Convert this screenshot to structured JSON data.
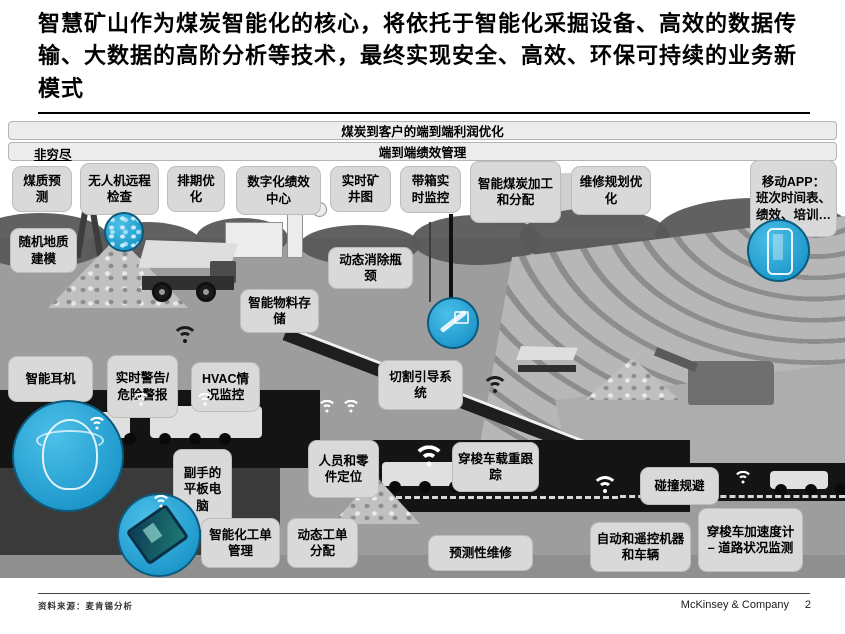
{
  "title": "智慧矿山作为煤炭智能化的核心，将依托于智能化采掘设备、高效的数据传输、大数据的高阶分析等技术，最终实现安全、高效、环保可持续的业务新模式",
  "banners": {
    "profit_bar": "煤炭到客户的端到端利润优化",
    "performance_bar": "端到端绩效管理",
    "not_exhaustive": "非穷尽"
  },
  "top_labels": [
    "煤质预测",
    "无人机远程检查",
    "排期优化",
    "数字化绩效中心",
    "实时矿井图",
    "带箱实时监控",
    "智能煤炭加工和分配",
    "维修规划优化",
    "移动APP：班次时间表、绩效、培训…"
  ],
  "scene_labels": [
    "随机地质建模",
    "动态消除瓶颈",
    "智能物料存储",
    "智能耳机",
    "实时警告/危险警报",
    "HVAC情况监控",
    "切割引导系统",
    "副手的平板电脑",
    "人员和零件定位",
    "穿梭车载重跟踪",
    "碰撞规避",
    "智能化工单管理",
    "动态工单分配",
    "预测性维修",
    "自动和遥控机器和车辆",
    "穿梭车加速度计 – 道路状况监测"
  ],
  "icon_names": [
    "wifi-icon",
    "drone-callout",
    "smartphone-callout",
    "cutting-machine-callout",
    "miner-helmet-callout",
    "tablet-callout"
  ],
  "colors": {
    "callout_blue": "#2aa5d8",
    "box_gray": "#d9d9d9",
    "tunnel_black": "#141414",
    "ground_gray": "#9d9d9d"
  },
  "footer": {
    "source": "资料来源：麦肯锡分析",
    "brand": "McKinsey & Company",
    "page": "2"
  }
}
